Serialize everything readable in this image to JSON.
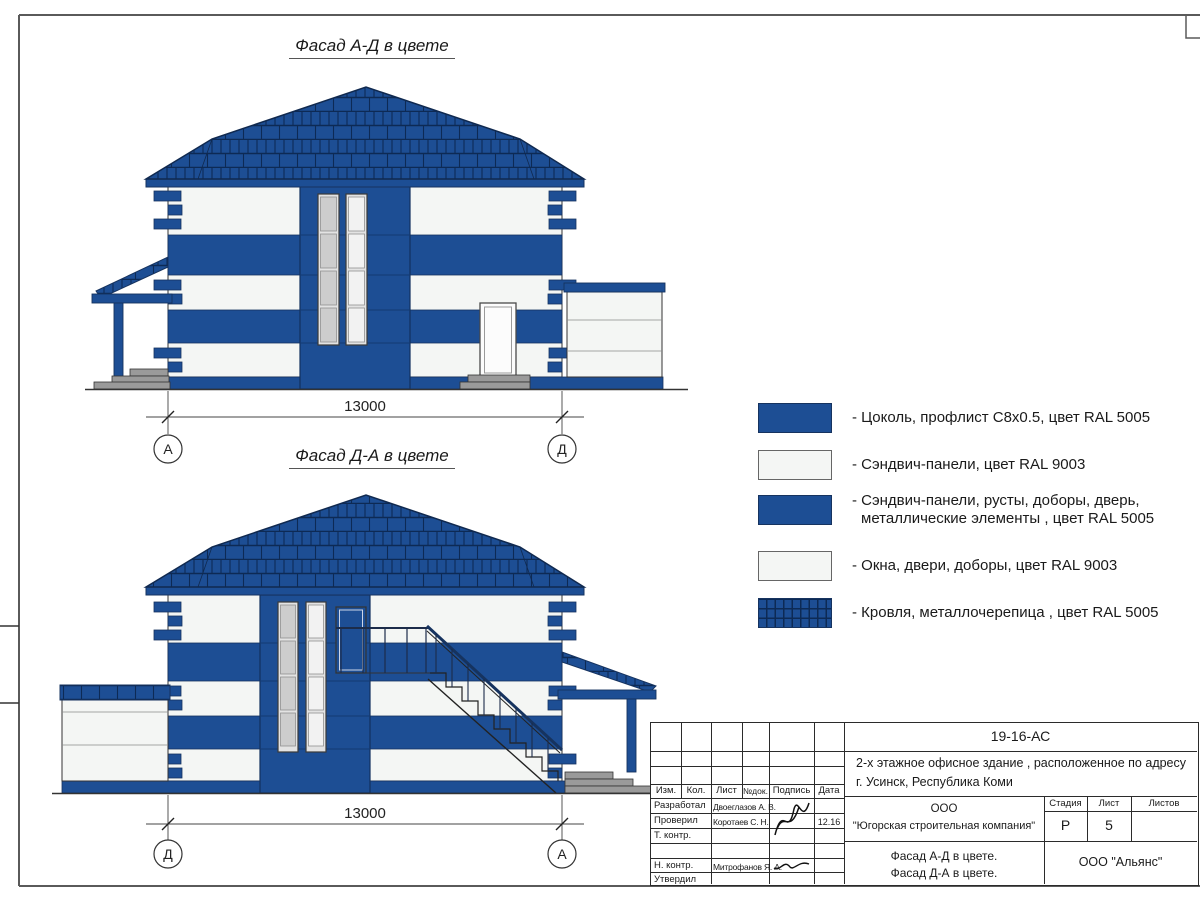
{
  "colors": {
    "ral5005_blue": "#1d4e94",
    "ral9003_white": "#f4f6f4",
    "roof_line": "#0d2a55",
    "steps_gray": "#9a9a9a"
  },
  "facade_top": {
    "title": "Фасад А-Д в цвете",
    "dim": "13000",
    "axis_left": "А",
    "axis_right": "Д"
  },
  "facade_bottom": {
    "title": "Фасад Д-А в цвете",
    "dim": "13000",
    "axis_left": "Д",
    "axis_right": "А"
  },
  "legend": {
    "items": [
      {
        "swatch": "blue",
        "text": "- Цоколь, профлист С8х0.5, цвет RAL 5005"
      },
      {
        "swatch": "white",
        "text": "- Сэндвич-панели, цвет RAL 9003"
      },
      {
        "swatch": "blue",
        "text": "- Сэндвич-панели, русты, доборы, дверь,",
        "text2": "металлические элементы , цвет RAL 5005"
      },
      {
        "swatch": "white",
        "text": "- Окна, двери, доборы, цвет RAL 9003"
      },
      {
        "swatch": "roof",
        "text": "- Кровля, металлочерепица , цвет RAL 5005"
      }
    ]
  },
  "titleblock": {
    "doc_code": "19-16-АС",
    "object_line1": "2-х этажное офисное здание , расположенное по адресу",
    "object_line2": "г. Усинск, Республика Коми",
    "headers": {
      "izm": "Изм.",
      "kol": "Кол.",
      "list": "Лист",
      "ndok": "№док.",
      "podpis": "Подпись",
      "data": "Дата"
    },
    "rows": [
      {
        "role": "Разработал",
        "name": "Двоеглазов А. В.",
        "date": ""
      },
      {
        "role": "Проверил",
        "name": "Коротаев С. Н.",
        "date": "12.16"
      },
      {
        "role": "Т. контр.",
        "name": "",
        "date": ""
      },
      {
        "role": "",
        "name": "",
        "date": ""
      },
      {
        "role": "Н. контр.",
        "name": "Митрофанов Я. А.",
        "date": ""
      },
      {
        "role": "Утвердил",
        "name": "",
        "date": ""
      }
    ],
    "company_line1": "ООО",
    "company_line2": "\"Югорская строительная компания\"",
    "stage_label": "Стадия",
    "sheet_label": "Лист",
    "sheets_label": "Листов",
    "stage_value": "Р",
    "sheet_value": "5",
    "sheets_value": "",
    "drawing_title1": "Фасад А-Д в цвете.",
    "drawing_title2": "Фасад Д-А в цвете.",
    "contractor": "ООО \"Альянс\""
  }
}
